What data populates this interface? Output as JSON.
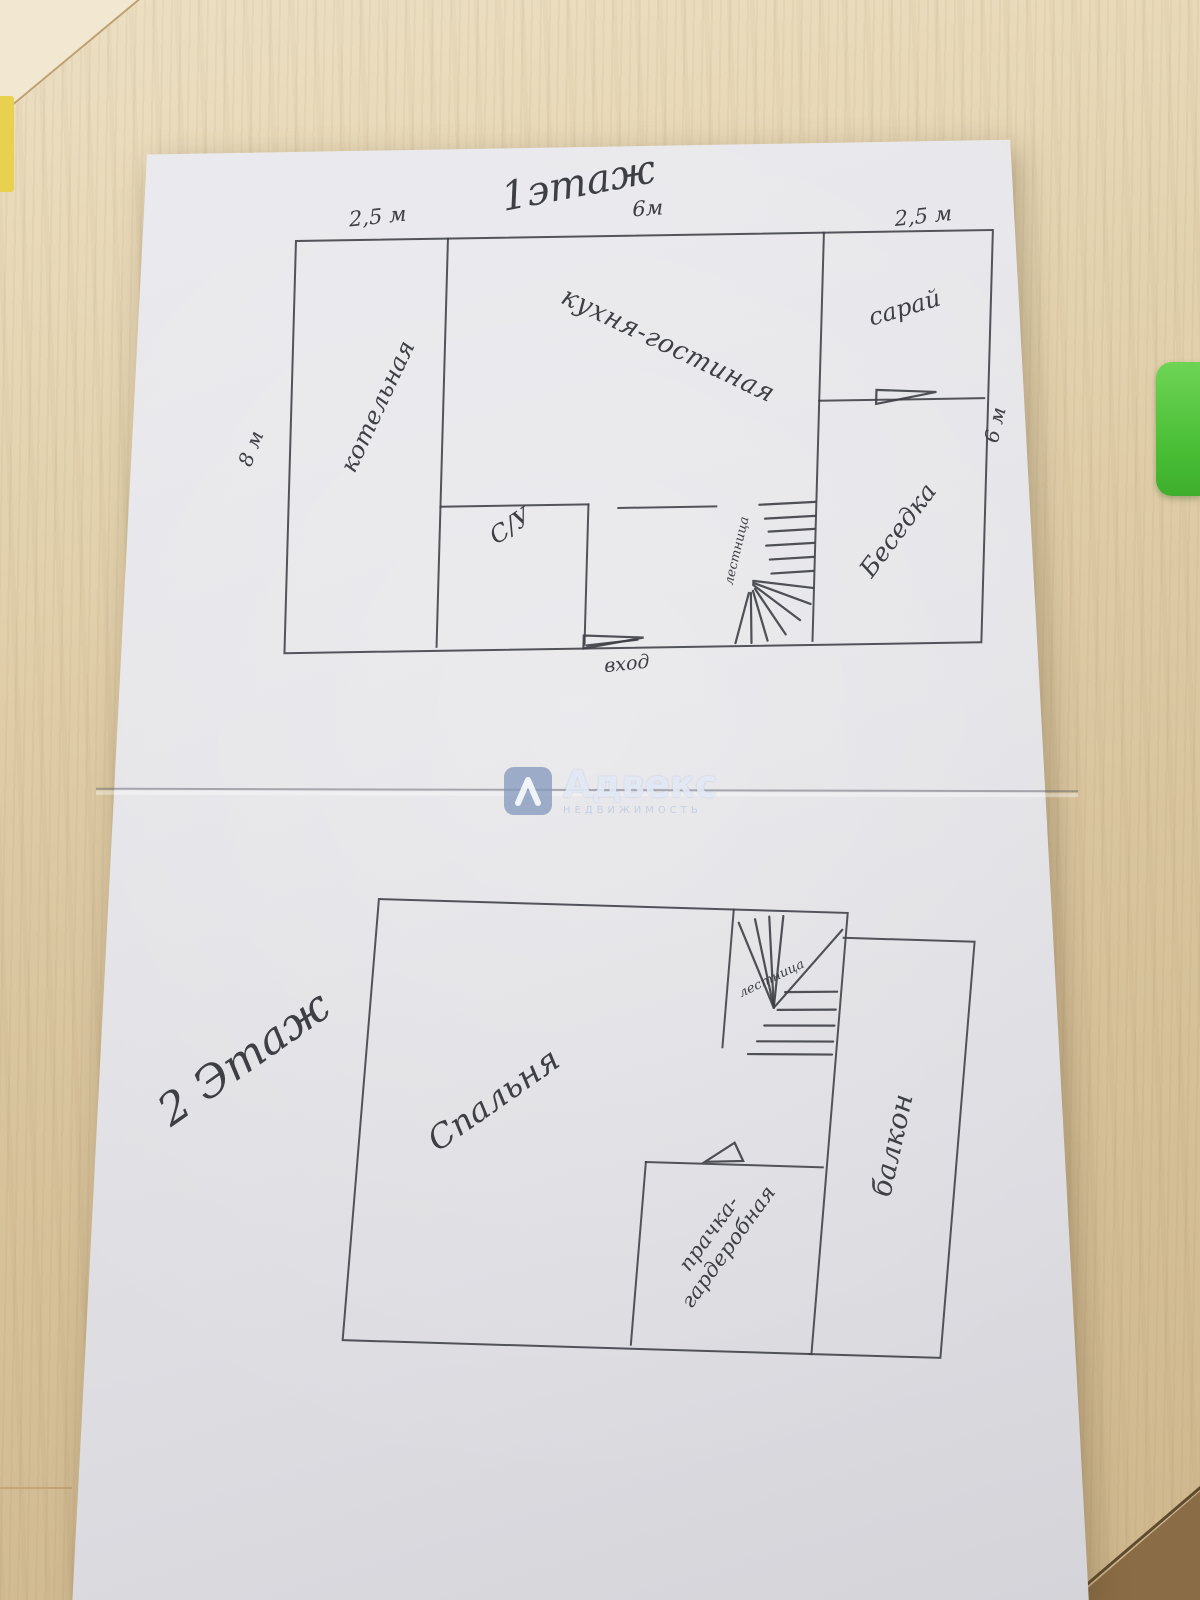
{
  "watermark": {
    "brand": "Адвекс",
    "subtitle": "НЕДВИЖИМОСТЬ"
  },
  "floor1": {
    "title": "1этаж",
    "dim_top_left": "2,5 м",
    "dim_top_mid": "6м",
    "dim_top_right": "2,5 м",
    "dim_left": "8 м",
    "dim_right": "6 м",
    "room_boiler": "котельная",
    "room_kitchen": "кухня-гостиная",
    "room_shed": "сарай",
    "room_bath": "С/У",
    "room_stairs": "лестница",
    "room_gazebo": "Беседка",
    "entrance": "вход"
  },
  "floor2": {
    "title": "2 Этаж",
    "room_bedroom": "Спальня",
    "room_stairs": "лестница",
    "room_laundry_line1": "прачка-",
    "room_laundry_line2": "гардеробная",
    "room_balcony": "балкон"
  }
}
